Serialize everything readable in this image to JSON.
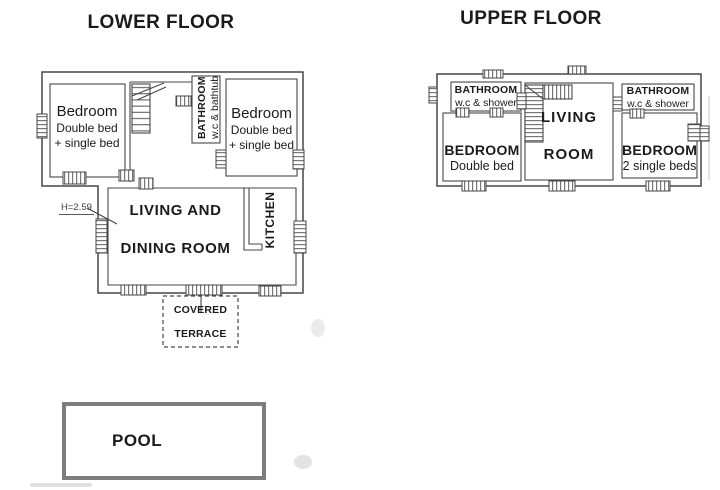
{
  "lower_floor": {
    "title": "LOWER FLOOR",
    "bedroom_left": {
      "name": "Bedroom",
      "detail1": "Double bed",
      "detail2": "+ single bed"
    },
    "bedroom_right": {
      "name": "Bedroom",
      "detail1": "Double bed",
      "detail2": "+ single bed"
    },
    "bathroom": {
      "name": "BATHROOM",
      "detail": "w.c & bathtub"
    },
    "living_dining": {
      "line1": "LIVING AND",
      "line2": "DINING ROOM"
    },
    "kitchen_label": "KITCHEN",
    "terrace": {
      "line1": "COVERED",
      "line2": "TERRACE"
    },
    "height_label": "H=2.59"
  },
  "upper_floor": {
    "title": "UPPER FLOOR",
    "bathroom_left": {
      "name": "BATHROOM",
      "detail": "w.c & shower"
    },
    "bedroom_left": {
      "name": "BEDROOM",
      "detail": "Double bed"
    },
    "living_room": {
      "line1": "LIVING",
      "line2": "ROOM"
    },
    "bathroom_right": {
      "name": "BATHROOM",
      "detail": "w.c & shower"
    },
    "bedroom_right": {
      "name": "BEDROOM",
      "detail": "2 single beds"
    }
  },
  "pool": {
    "label": "POOL"
  },
  "colors": {
    "wall_line": "#474747",
    "text": "#1b1b1b",
    "pool_border": "#7d7d7d",
    "background": "#ffffff"
  }
}
